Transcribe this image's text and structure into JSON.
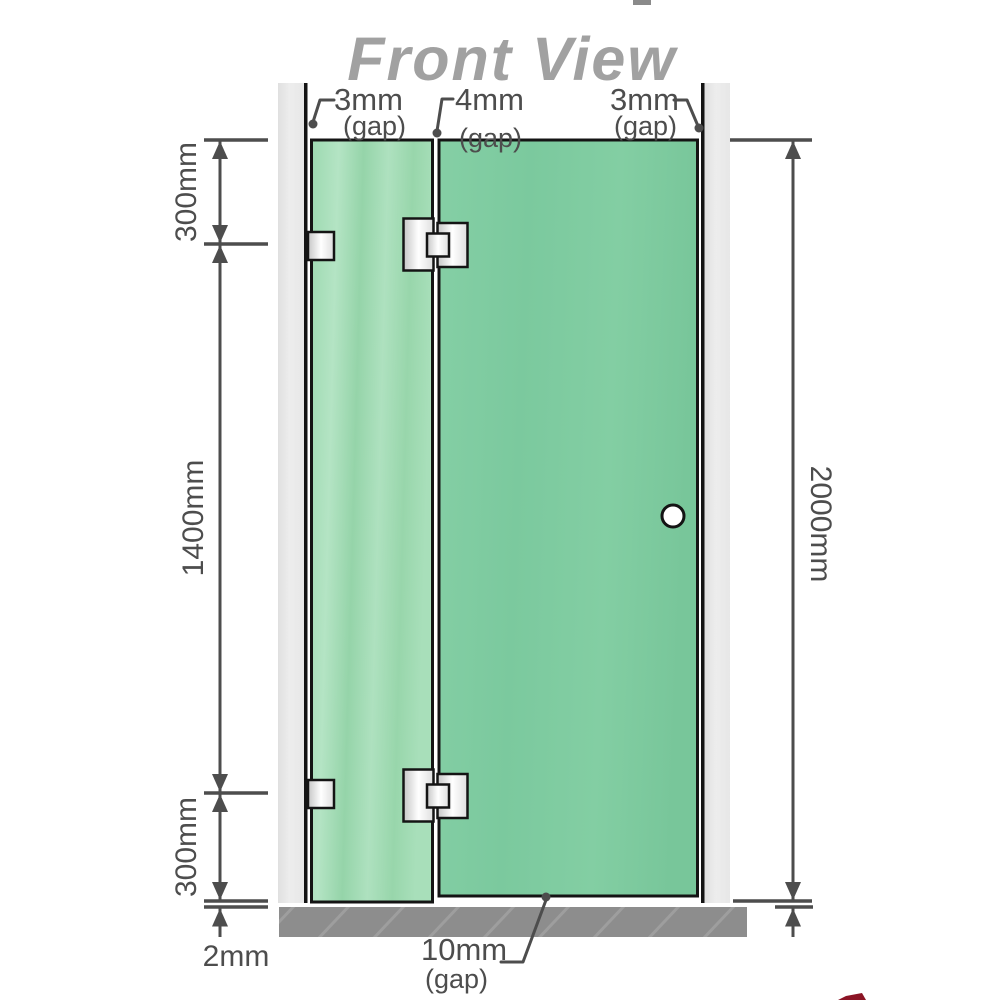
{
  "title": "Front View",
  "gap_labels": {
    "top_left": {
      "value": "3mm",
      "suffix": "(gap)"
    },
    "top_middle": {
      "value": "4mm",
      "suffix": "(gap)"
    },
    "top_right": {
      "value": "3mm",
      "suffix": "(gap)"
    },
    "bottom": {
      "value": "10mm",
      "suffix": "(gap)"
    }
  },
  "dimension_labels": {
    "left_top_segment": "300mm",
    "left_middle_segment": "1400mm",
    "left_bottom_segment": "300mm",
    "left_floor_gap": "2mm",
    "right_total_height": "2000mm"
  },
  "colors": {
    "glass_fixed_panel": "#a0dab4",
    "glass_door_panel": "#7ccaa0",
    "wall": "#e9e9e9",
    "wall_edge": "#141414",
    "floor": "#8d8d8d",
    "floor_hatch": "#9e9e9e",
    "hinge_metal": "#e8e8e8",
    "dimension_lines": "#4d4d4d",
    "title_text": "#a1a1a1",
    "knob_fill": "#ffffff",
    "logo_sliver": "#8b1425"
  }
}
